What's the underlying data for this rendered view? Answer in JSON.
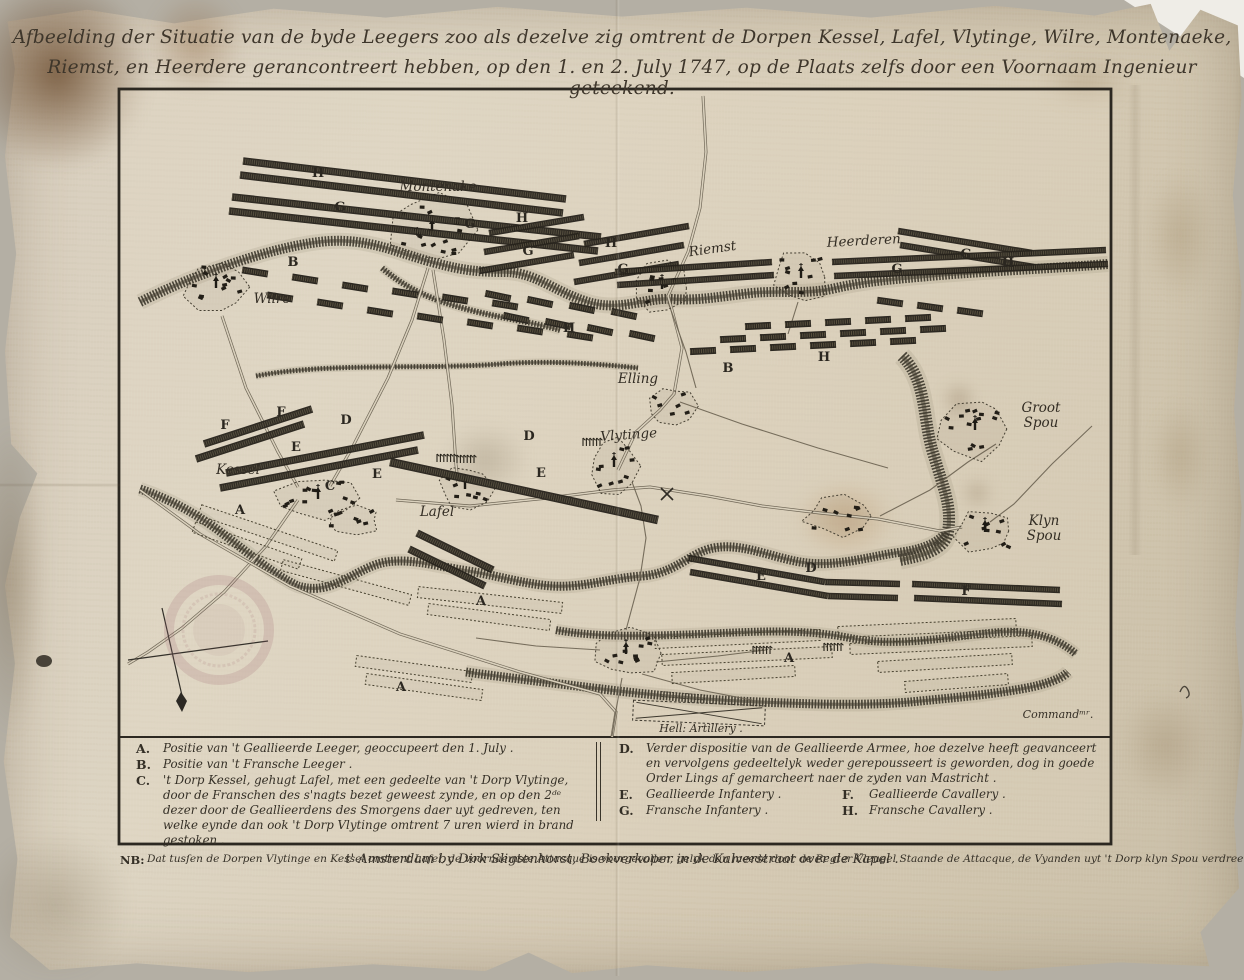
{
  "title": {
    "line1": "Afbeelding der Situatie van de byde Leegers zoo als dezelve zig omtrent de Dorpen Kessel, Lafel, Vlytinge, Wilre, Montenaeke,",
    "line2": "Riemst, en Heerdere gerancontreert hebben, op den 1. en 2. July 1747, op de Plaats zelfs door een Voornaam Ingenieur geteekend."
  },
  "map": {
    "places": [
      {
        "slug": "montenake",
        "name": "Montenake",
        "x": 438,
        "y": 191
      },
      {
        "slug": "wilre",
        "name": "Wilre",
        "x": 272,
        "y": 303
      },
      {
        "slug": "riemst",
        "name": "Riemst",
        "x": 713,
        "y": 253,
        "rotate": -8
      },
      {
        "slug": "heerderen",
        "name": "Heerderen",
        "x": 864,
        "y": 245,
        "rotate": -3
      },
      {
        "slug": "elling",
        "name": "Elling",
        "x": 638,
        "y": 383
      },
      {
        "slug": "vlytinge",
        "name": "Vlytinge",
        "x": 629,
        "y": 439,
        "rotate": -4
      },
      {
        "slug": "kessel",
        "name": "Kessel",
        "x": 238,
        "y": 474
      },
      {
        "slug": "lafel",
        "name": "Lafel",
        "x": 437,
        "y": 516
      },
      {
        "slug": "groot-spou",
        "name": "Groot Spou",
        "x": 1041,
        "y": 412,
        "stacked": true
      },
      {
        "slug": "klyn-spou",
        "name": "Klyn Spou",
        "x": 1044,
        "y": 525,
        "stacked": true
      },
      {
        "slug": "hell-artillery",
        "name": "Hell: Artillery .",
        "x": 701,
        "y": 732,
        "small": true
      },
      {
        "slug": "commander",
        "name": "Commandᵐʳ.",
        "x": 1058,
        "y": 718,
        "small": true
      }
    ],
    "unit_labels": [
      {
        "letter": "H",
        "x": 318,
        "y": 177
      },
      {
        "letter": "G",
        "x": 340,
        "y": 211
      },
      {
        "letter": "B",
        "x": 293,
        "y": 266
      },
      {
        "letter": "G",
        "x": 470,
        "y": 228
      },
      {
        "letter": "H",
        "x": 522,
        "y": 222
      },
      {
        "letter": "G",
        "x": 528,
        "y": 255
      },
      {
        "letter": "H",
        "x": 611,
        "y": 247
      },
      {
        "letter": "G",
        "x": 623,
        "y": 273
      },
      {
        "letter": "H",
        "x": 569,
        "y": 332
      },
      {
        "letter": "G",
        "x": 966,
        "y": 258
      },
      {
        "letter": "G",
        "x": 897,
        "y": 273
      },
      {
        "letter": "H",
        "x": 1008,
        "y": 267
      },
      {
        "letter": "B",
        "x": 728,
        "y": 372
      },
      {
        "letter": "H",
        "x": 824,
        "y": 361
      },
      {
        "letter": "F",
        "x": 225,
        "y": 429
      },
      {
        "letter": "F",
        "x": 281,
        "y": 416
      },
      {
        "letter": "E",
        "x": 296,
        "y": 451
      },
      {
        "letter": "D",
        "x": 346,
        "y": 424
      },
      {
        "letter": "D",
        "x": 529,
        "y": 440
      },
      {
        "letter": "E",
        "x": 377,
        "y": 478
      },
      {
        "letter": "E",
        "x": 541,
        "y": 477
      },
      {
        "letter": "C",
        "x": 330,
        "y": 490
      },
      {
        "letter": "A",
        "x": 240,
        "y": 514
      },
      {
        "letter": "A",
        "x": 481,
        "y": 605
      },
      {
        "letter": "A",
        "x": 401,
        "y": 691
      },
      {
        "letter": "A",
        "x": 789,
        "y": 662
      },
      {
        "letter": "E",
        "x": 761,
        "y": 580
      },
      {
        "letter": "D",
        "x": 811,
        "y": 572
      },
      {
        "letter": "F",
        "x": 966,
        "y": 595
      }
    ]
  },
  "legend": {
    "items_left": [
      {
        "key": "A.",
        "text": "Positie van 't Geallieerde Leeger, geoccupeert den 1. July ."
      },
      {
        "key": "B.",
        "text": "Positie van 't Fransche Leeger ."
      },
      {
        "key": "C.",
        "text": "'t Dorp Kessel, gehugt Lafel, met een gedeelte van 't Dorp Vlytinge, door de Franschen des s'nagts bezet geweest zynde, en op den 2ᵈᵉ dezer door de Geallieerdens des Smorgens daer uyt gedreven, ten welke eynde dan ook 't Dorp Vlytinge omtrent 7 uren wierd in brand gestoken ."
      }
    ],
    "items_right": [
      {
        "key": "D.",
        "text": "Verder dispositie van de Geallieerde Armee, hoe dezelve heeft geavanceert en vervolgens gedeeltelyk weder gerepousseert is geworden, dog in goede Order Lings af gemarcheert naer de zyden van Mastricht ."
      },
      {
        "key": "E.",
        "text": "Geallieerde Infantery ."
      },
      {
        "key": "F.",
        "text": "Geallieerde Cavallery ."
      },
      {
        "key": "G.",
        "text": "Fransche Infantery ."
      },
      {
        "key": "H.",
        "text": "Fransche Cavallery ."
      }
    ],
    "nb_key": "NB:",
    "nb_text": "Dat tusſen de Dorpen Vlytinge en Kessel omtrent Lafel, de voornaemste Attacque is voorgevallen, gelyk dan meede door de Regter Vleugel Staande de Attacque, de Vyanden uyt 't Dorp klyn Spou verdreeven zyn geworden ."
  },
  "imprint": "t' Amsterdam by Dirk Sligtenhorst, Boekverkoper in de Kalverstraat over de Kapel ."
}
